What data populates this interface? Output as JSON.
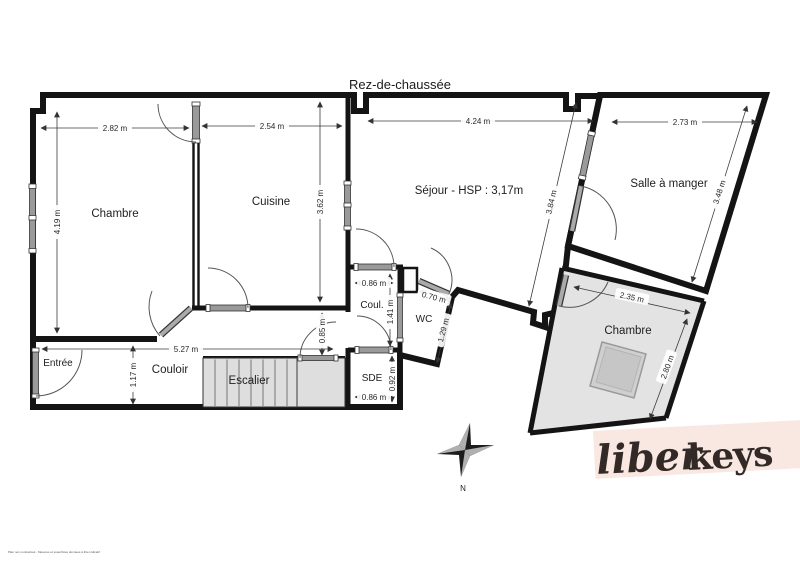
{
  "title": "Rez-de-chaussée",
  "rooms": {
    "chambre1": "Chambre",
    "cuisine": "Cuisine",
    "sejour": "Séjour - HSP : 3,17m",
    "salle_a_manger": "Salle à manger",
    "chambre2": "Chambre",
    "entree": "Entrée",
    "couloir": "Couloir",
    "escalier": "Escalier",
    "coul": "Coul.",
    "wc": "WC",
    "sde": "SDE"
  },
  "dimensions": {
    "chambre1_w": "2.82 m",
    "chambre1_h": "4.19 m",
    "cuisine_w": "2.54 m",
    "cuisine_h": "3.62 m",
    "sejour_w": "4.24 m",
    "sejour_diag": "3.84 m",
    "salle_a_manger_w": "2.73 m",
    "salle_a_manger_h": "3.48 m",
    "chambre2_w": "2.35 m",
    "chambre2_h": "2.80 m",
    "couloir_w": "5.27 m",
    "couloir_h": "1.17 m",
    "passage_h": "0.85 m",
    "coul_w": "0.86 m",
    "coul_h": "1.41 m",
    "wc_w": "0.70 m",
    "wc_h": "1.29 m",
    "sde_h": "0.92 m",
    "sde_w": "0.86 m"
  },
  "compass": {
    "north_label": "N"
  },
  "logo": {
    "script": "liber",
    "bold": "keys"
  },
  "disclaimer": "Plan non contractuel - Mesures et superficies données à titre indicatif",
  "colors": {
    "room_fill": "#e3e3e3",
    "wall": "#141414",
    "logo_band": "#f9e8e1",
    "logo_text": "#332a28"
  }
}
